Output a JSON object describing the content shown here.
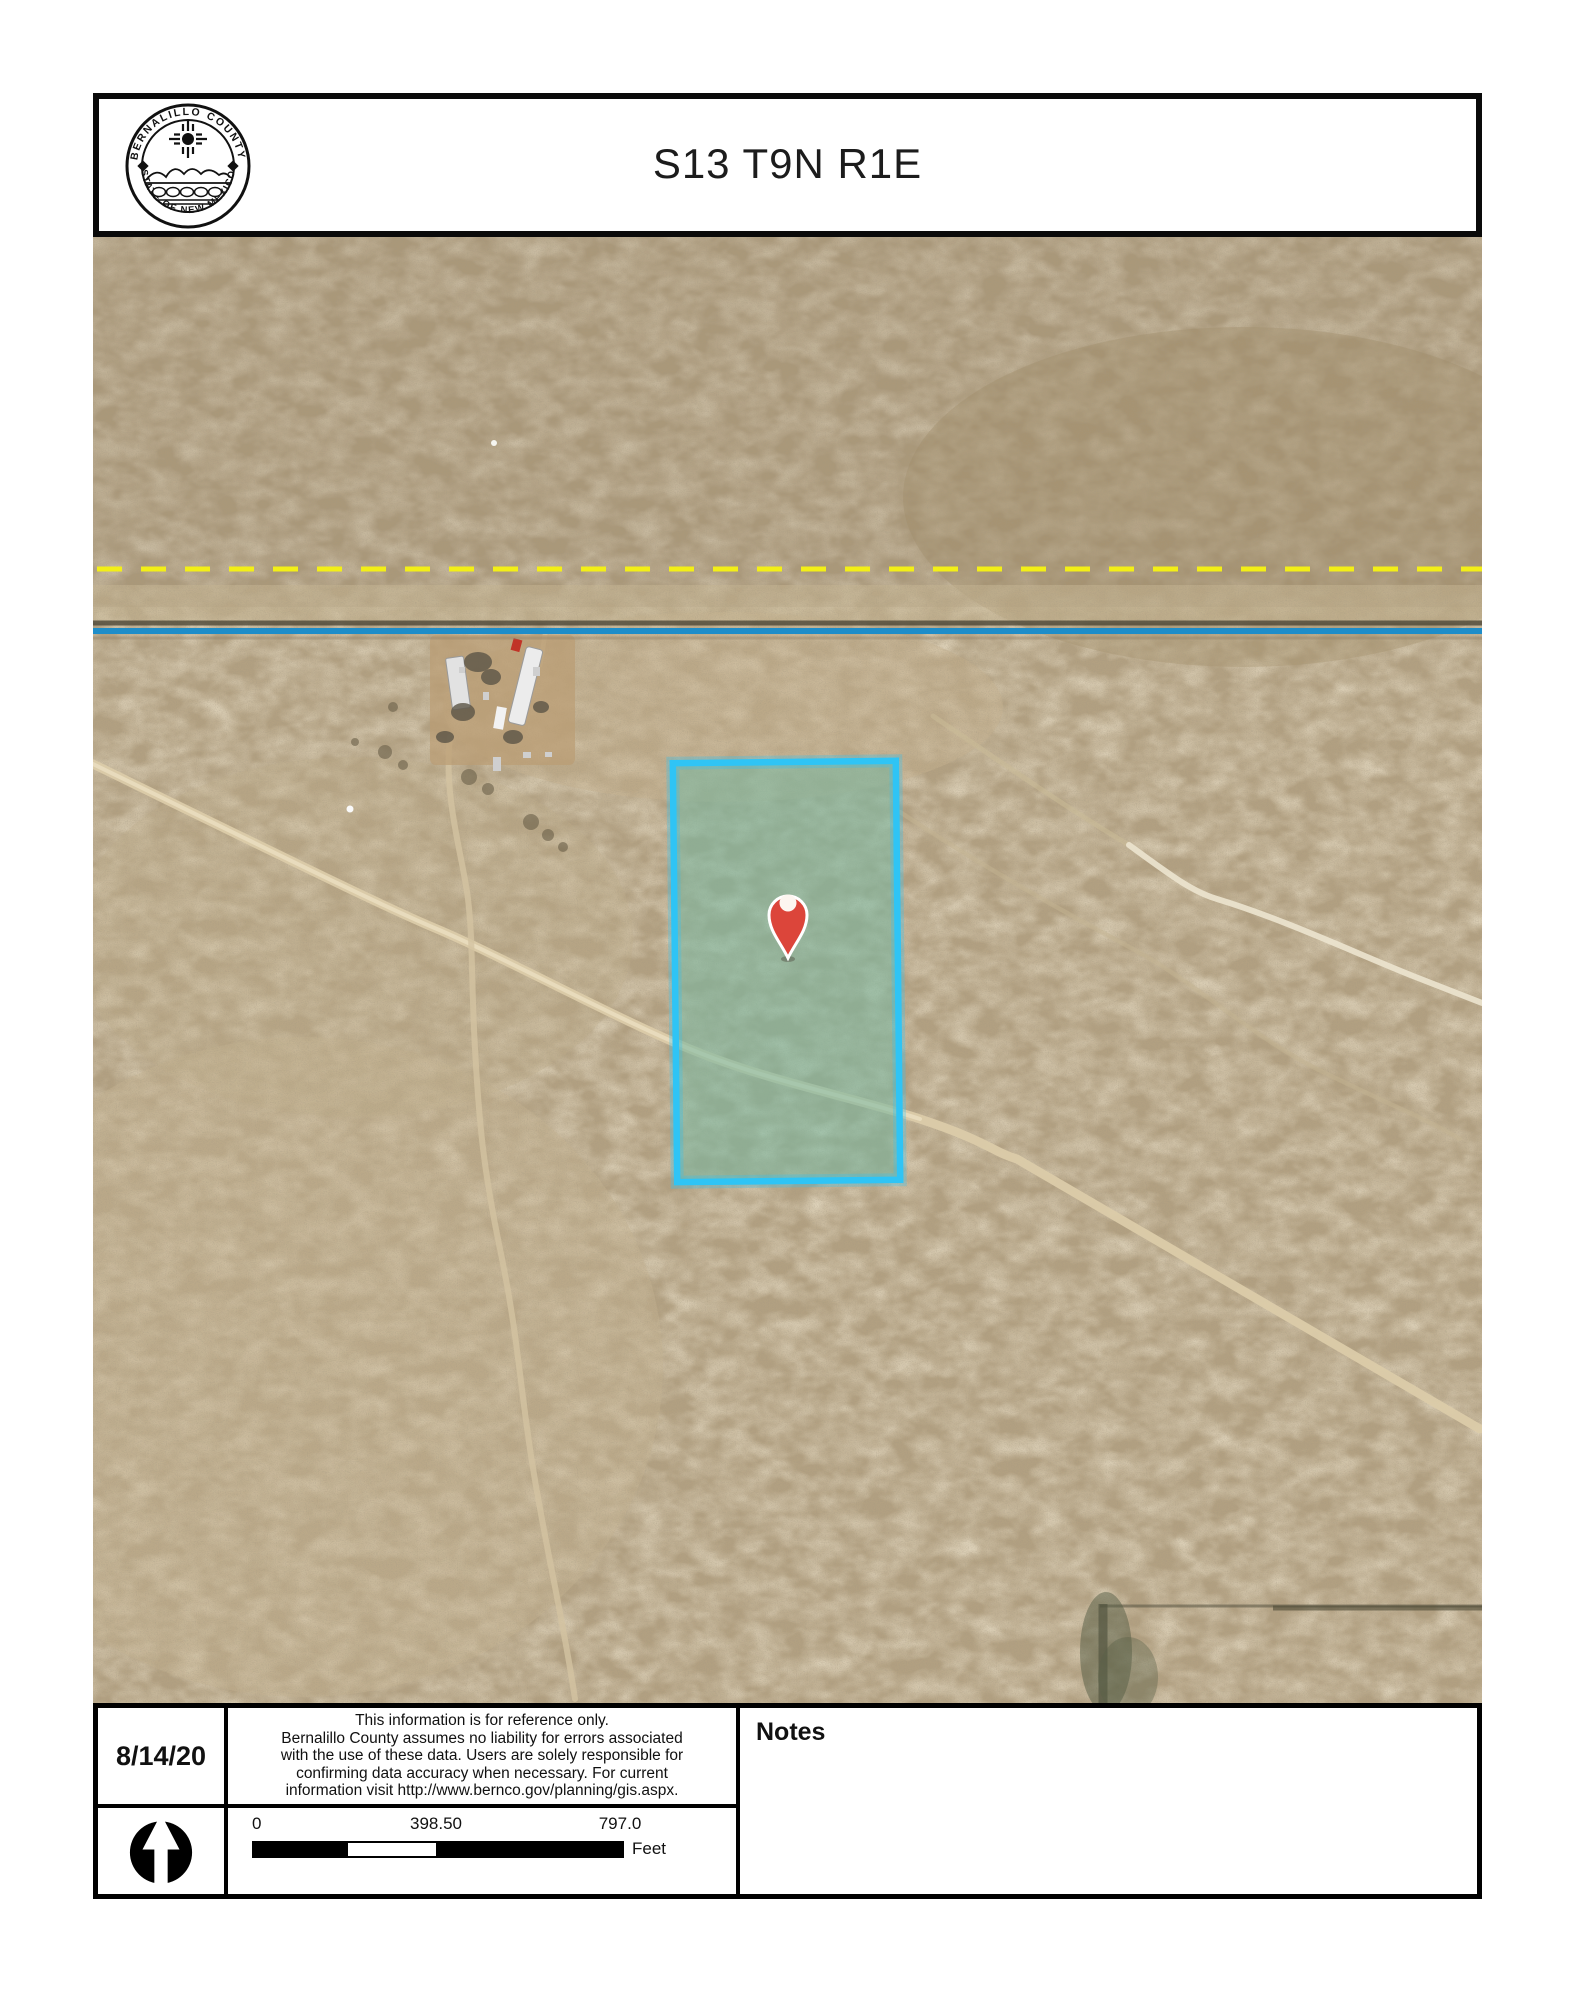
{
  "header": {
    "title": "S13 T9N R1E",
    "seal": {
      "top_text": "BERNALILLO COUNTY",
      "bottom_text": "STATE OF NEW MEXICO"
    }
  },
  "map": {
    "legend": {
      "section_boundary_color": "#f3ef16",
      "road_centerline_color": "#1e8dc9",
      "parcel_outline_color": "#2fc4f5",
      "parcel_fill_color": "rgba(120,183,160,0.58)",
      "pin_color": "#dc453a",
      "terrain_color": "#b2a081"
    }
  },
  "footer": {
    "date": "8/14/20",
    "disclaimer_lines": [
      "This information is for reference only.",
      "Bernalillo County assumes no liability for errors associated",
      "with the use of these data. Users are solely responsible for",
      "confirming data accuracy when necessary. For current",
      "information visit http://www.bernco.gov/planning/gis.aspx."
    ],
    "notes_label": "Notes",
    "scale": {
      "zero": "0",
      "mid": "398.50",
      "max": "797.0",
      "unit": "Feet"
    }
  }
}
